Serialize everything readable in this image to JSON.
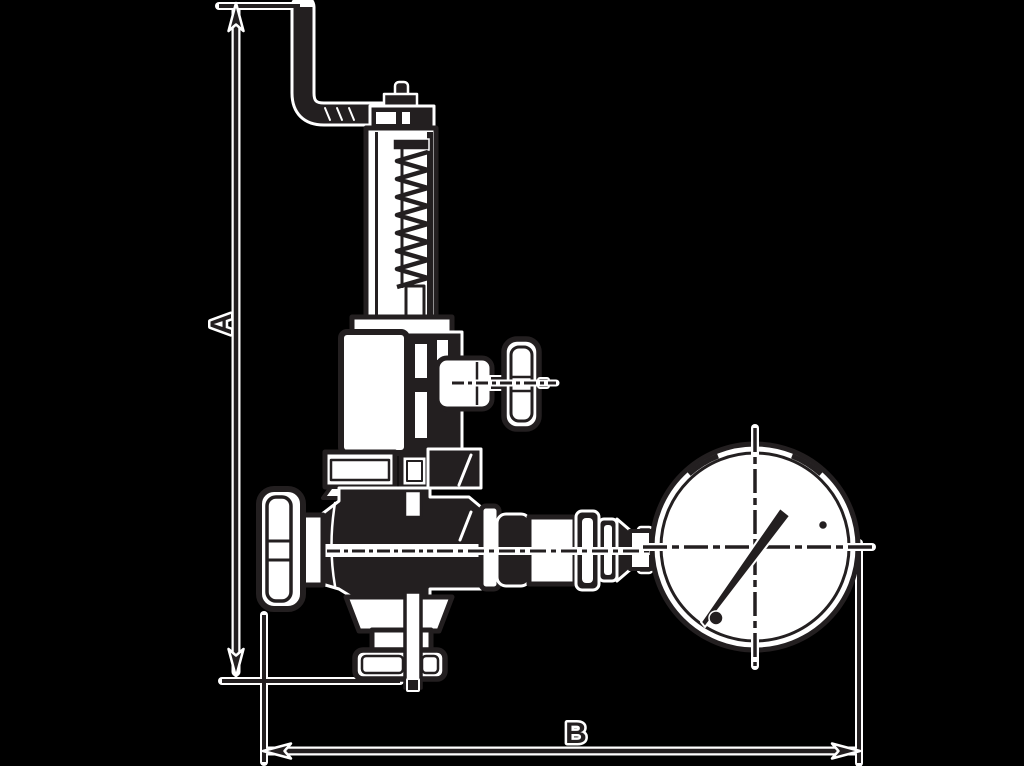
{
  "page": {
    "background": "#000000"
  },
  "drawing": {
    "description": "Dimensioned outline drawing of a spring-loaded safety valve group with test lever, shut-off handwheels, drain flange and pressure gauge",
    "ink_color": "#231f20",
    "halo_color": "#ffffff",
    "dimension_a": {
      "label": "A"
    },
    "dimension_b": {
      "label": "B"
    }
  }
}
